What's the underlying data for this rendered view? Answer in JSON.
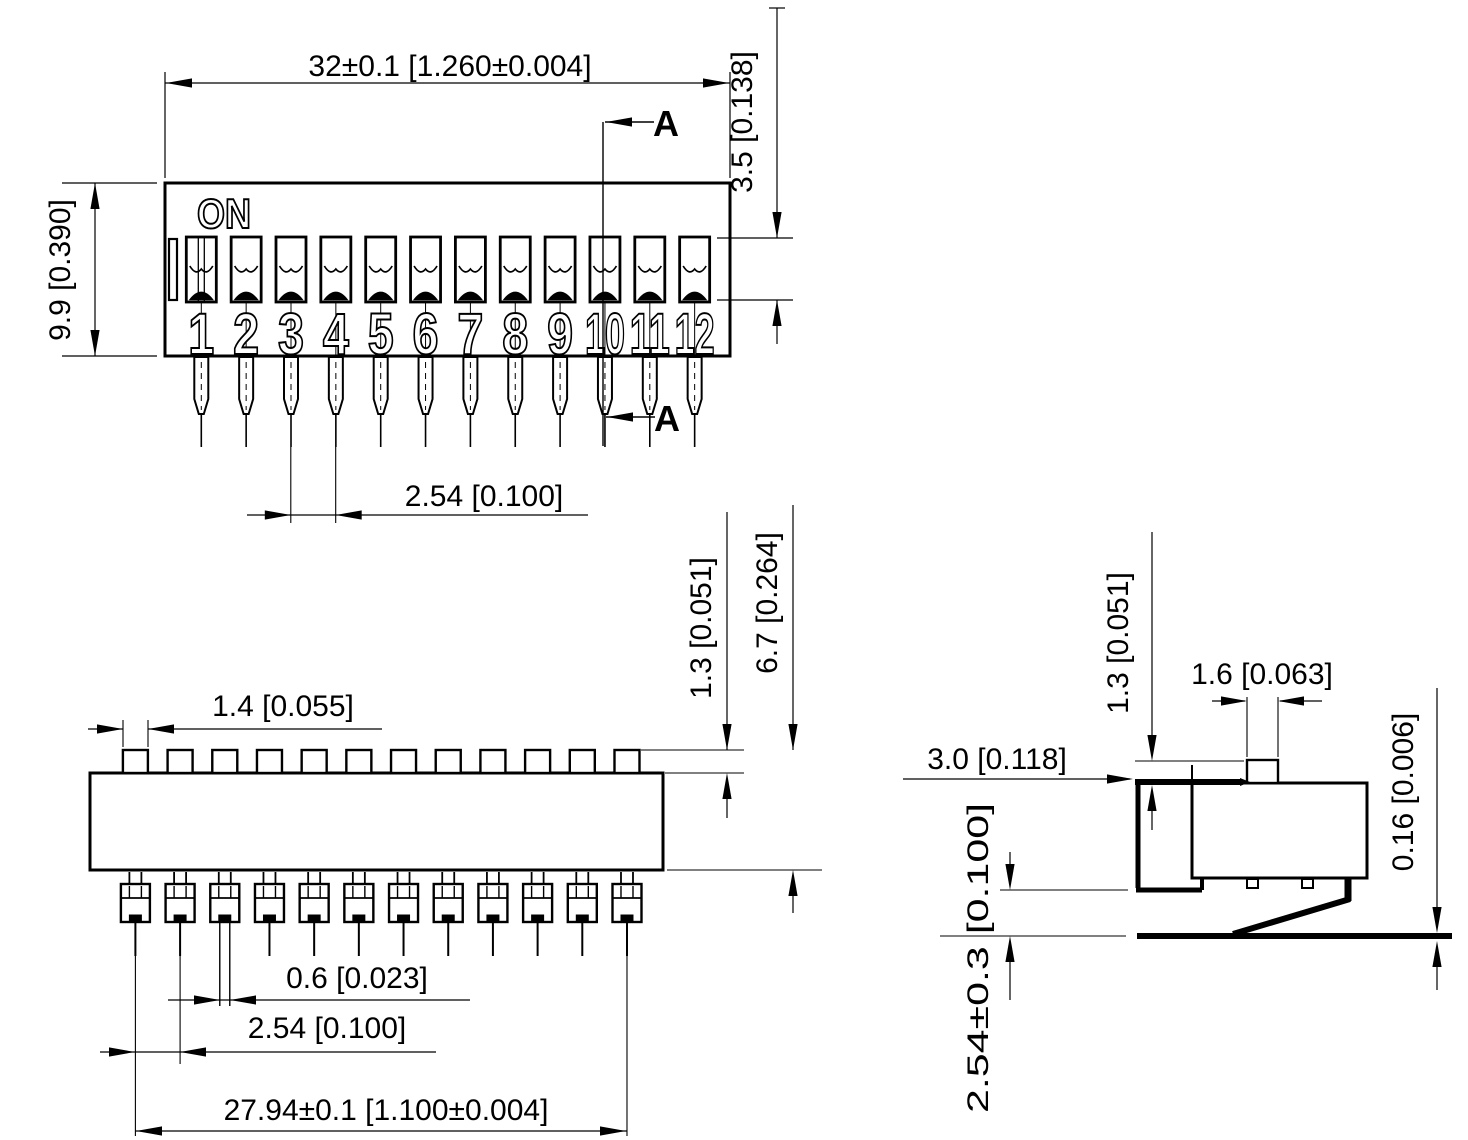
{
  "drawing": {
    "front_view": {
      "on_label": "ON",
      "switch_numbers": [
        "1",
        "2",
        "3",
        "4",
        "5",
        "6",
        "7",
        "8",
        "9",
        "10",
        "11",
        "12"
      ],
      "section_label": "A",
      "dim_width": "32±0.1  [1.260±0.004]",
      "dim_height": "9.9  [0.390]",
      "dim_actuator_height": "3.5  [0.138]",
      "dim_pitch": "2.54  [0.100]"
    },
    "bottom_view": {
      "dim_actuator_width": "1.4  [0.055]",
      "dim_actuator_height": "1.3  [0.051]",
      "dim_body_height": "6.7  [0.264]",
      "dim_lead_width": "0.6  [0.023]",
      "dim_pitch": "2.54  [0.100]",
      "dim_span": "27.94±0.1  [1.100±0.004]"
    },
    "side_view": {
      "dim_lead_offset": "3.0  [0.118]",
      "dim_actuator_height": "1.3  [0.051]",
      "dim_actuator_width": "1.6  [0.063]",
      "dim_coplanarity": "0.16  [0.006]",
      "dim_lead_pitch": "2.54±0.3  [0.100]"
    }
  }
}
